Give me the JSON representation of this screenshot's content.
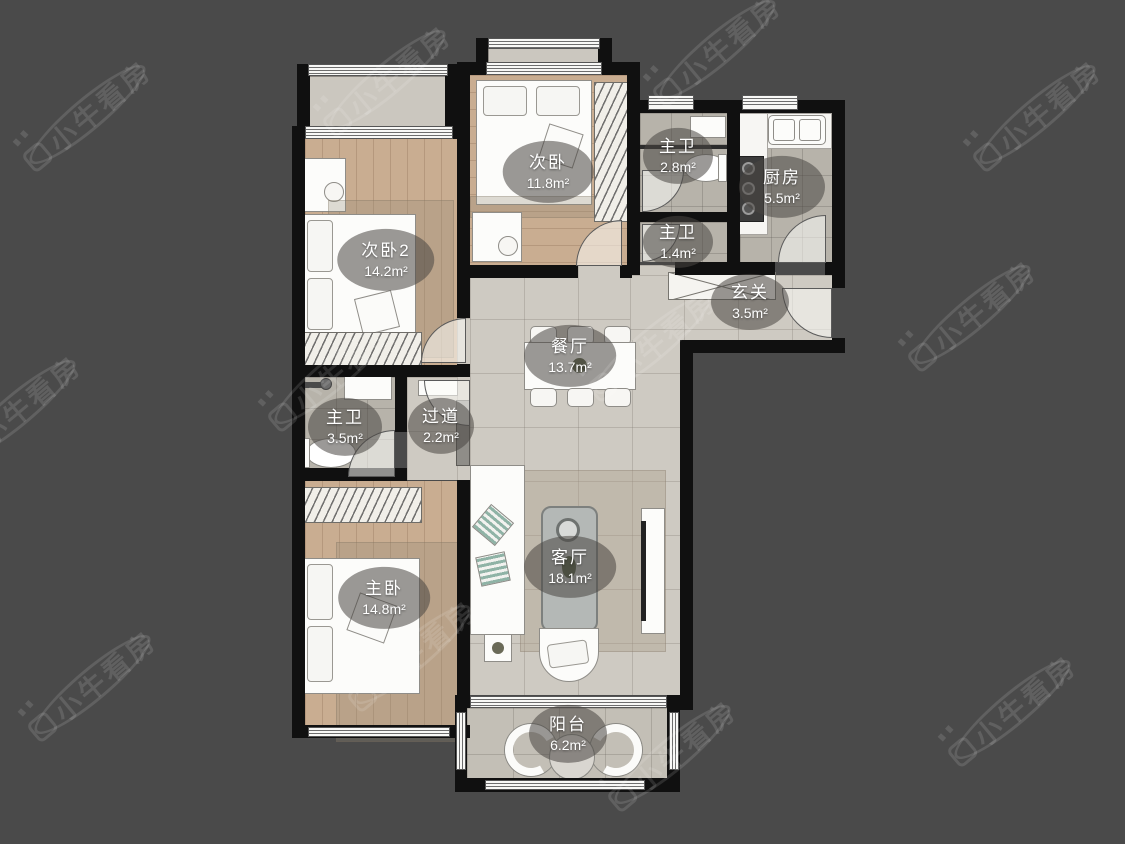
{
  "watermark": {
    "text": "小牛看房"
  },
  "palette": {
    "background": "#4a4a4a",
    "wall": "#101010",
    "wood_floor": "#c9ad91",
    "tile_floor": "#b7b3aa",
    "marble_floor": "#cecac2",
    "label_bubble": "rgba(72,70,66,0.55)",
    "label_text": "#ffffff"
  },
  "rooms": [
    {
      "name": "次卧",
      "area": "11.8m²"
    },
    {
      "name": "主卫",
      "area": "2.8m²"
    },
    {
      "name": "厨房",
      "area": "5.5m²"
    },
    {
      "name": "次卧2",
      "area": "14.2m²"
    },
    {
      "name": "主卫",
      "area": "1.4m²"
    },
    {
      "name": "玄关",
      "area": "3.5m²"
    },
    {
      "name": "餐厅",
      "area": "13.7m²"
    },
    {
      "name": "主卫",
      "area": "3.5m²"
    },
    {
      "name": "过道",
      "area": "2.2m²"
    },
    {
      "name": "主卧",
      "area": "14.8m²"
    },
    {
      "name": "客厅",
      "area": "18.1m²"
    },
    {
      "name": "阳台",
      "area": "6.2m²"
    }
  ]
}
